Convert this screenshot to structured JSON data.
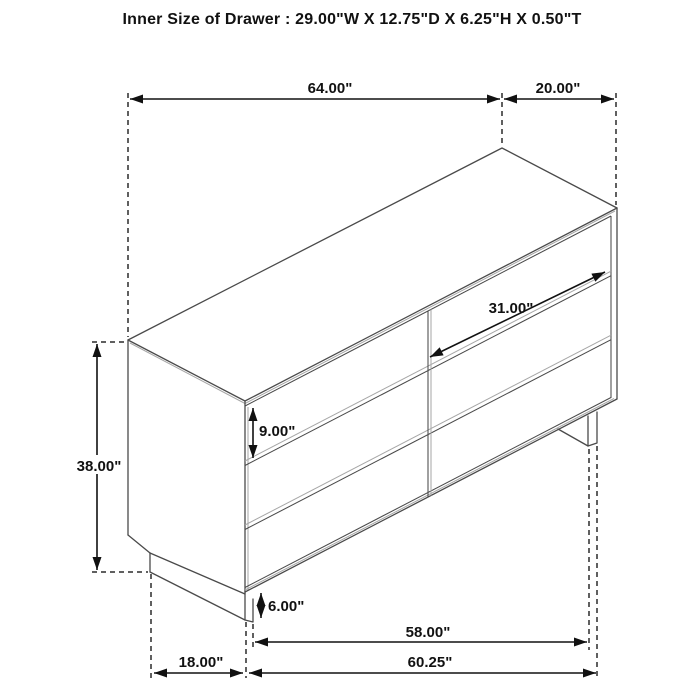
{
  "title": "Inner Size of Drawer : 29.00\"W X 12.75\"D X 6.25\"H X 0.50\"T",
  "figure": "six-drawer dresser isometric line drawing with dimension callouts",
  "dimensions": {
    "overall_width": "64.00\"",
    "overall_depth": "20.00\"",
    "overall_height": "38.00\"",
    "drawer_front_width": "31.00\"",
    "drawer_front_height": "9.00\"",
    "leg_height": "6.00\"",
    "leg_span_width": "58.00\"",
    "base_width": "60.25\"",
    "base_depth": "18.00\""
  },
  "colors": {
    "background": "#ffffff",
    "line": "#4a4a4a",
    "dimension_line": "#111111",
    "soft_line": "#a6a6a6",
    "text": "#111111"
  }
}
